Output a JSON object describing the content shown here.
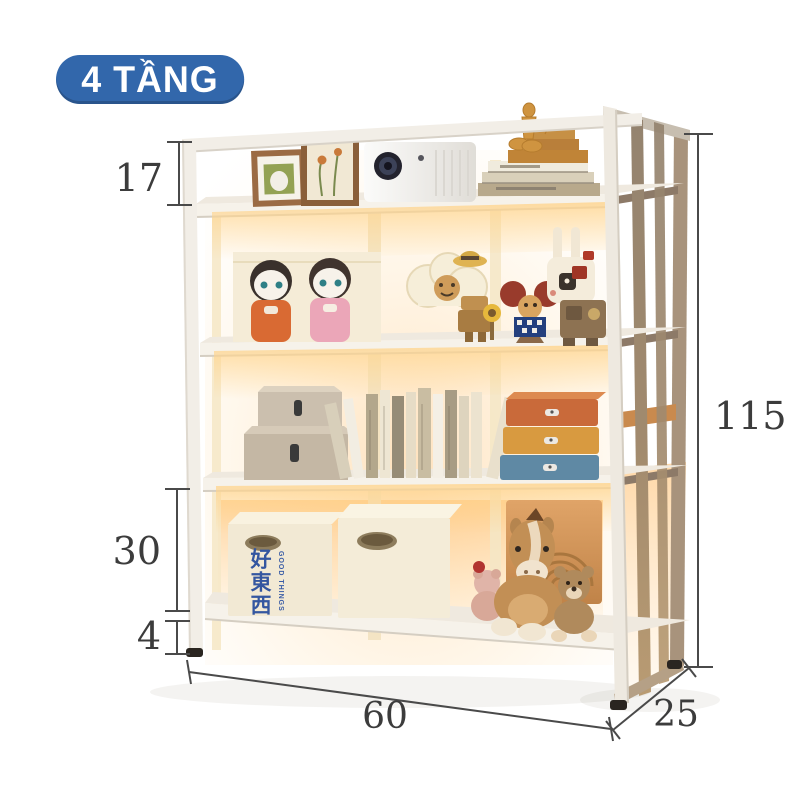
{
  "badge": {
    "label": "4 TẦNG"
  },
  "shelf": {
    "tier_count": "4"
  },
  "dimensions": {
    "top_tier_height": "17",
    "bottom_tier_height": "30",
    "foot_clearance": "4",
    "total_height": "115",
    "width": "60",
    "depth": "25"
  },
  "storage_bin": {
    "label_cn": "好東西",
    "label_en": "GOOD THINGS"
  },
  "colors": {
    "badge_background": "#3267ab",
    "badge_text": "#ffffff",
    "dimension_lines": "#4a4a4a",
    "frame_white": "#f1ede5",
    "side_panel_wood": "#a08a72",
    "warm_glow": "#f6c98e",
    "drawer_orange": "#c96a3a",
    "drawer_amber": "#d89a40",
    "drawer_blue": "#5f89a4",
    "bin_text_blue": "#3456a0"
  }
}
